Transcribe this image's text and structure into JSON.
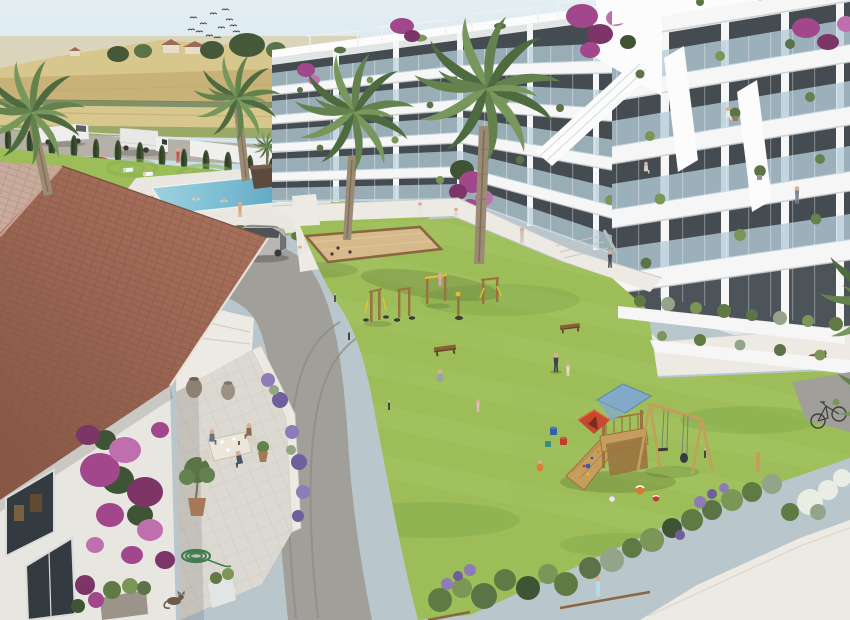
{
  "scene": {
    "type": "architectural-render",
    "title": "Aerial render of a Mediterranean apartment complex with communal garden, pool, playground and clubhouse",
    "setting": "sunny day, farmland horizon, flock of birds",
    "objects": [
      {
        "name": "sky",
        "label": "pale blue hazy sky"
      },
      {
        "name": "birds-flock",
        "label": "flock of birds",
        "count": 12
      },
      {
        "name": "farmland",
        "label": "golden crop fields with country houses and trees"
      },
      {
        "name": "perimeter-road",
        "label": "road with white van, box truck and parked red car"
      },
      {
        "name": "cypress-hedge",
        "label": "row of columnar cypress trees",
        "count": 15
      },
      {
        "name": "center-apartment-building",
        "label": "white apartment block, 5 balcony floors, rooftop pergolas"
      },
      {
        "name": "right-apartment-building",
        "label": "closer white apartment block with glass balconies and residents"
      },
      {
        "name": "bougainvillea",
        "label": "purple bougainvillea cascades"
      },
      {
        "name": "palm-trees",
        "label": "tall palm trees",
        "count": 5
      },
      {
        "name": "swimming-pool",
        "label": "communal pool with swimmers and loungers"
      },
      {
        "name": "lawn-art-circles",
        "label": "circular mown patterns on lawn"
      },
      {
        "name": "internal-road",
        "label": "curved asphalt drive with silver SUV and tyre tracks"
      },
      {
        "name": "central-lawn",
        "label": "large communal lawn"
      },
      {
        "name": "petanque-court",
        "label": "sand boules court with wooden border"
      },
      {
        "name": "outdoor-gym",
        "label": "wooden calisthenics equipment with yellow grips"
      },
      {
        "name": "playground",
        "label": "wooden play tower with blue roof, climbing ramp, swing set, red tent, buckets, beach balls"
      },
      {
        "name": "benches",
        "label": "wooden benches",
        "count": 3
      },
      {
        "name": "clubhouse",
        "label": "white clubhouse with terracotta tiled roof"
      },
      {
        "name": "clubhouse-terrace",
        "label": "dining terrace with three people at a table, olive tree, urns, coiled garden hose and a cat"
      },
      {
        "name": "lavender",
        "label": "lavender borders"
      },
      {
        "name": "shrub-border",
        "label": "mixed shrub border with white flowering bush"
      },
      {
        "name": "walkways",
        "label": "white concrete walkways"
      },
      {
        "name": "bicycle",
        "label": "bicycle leaning by planter"
      },
      {
        "name": "residents",
        "label": "people walking, children playing"
      }
    ],
    "counts": {
      "balcony_floors_center": 5,
      "balcony_floors_right": 5,
      "terrace_diners": 3,
      "swimmers": 2
    }
  },
  "palette": {
    "skyTop": "#e4eff3",
    "skyBot": "#c6dbe5",
    "fieldFar": "#d9d3b4",
    "fieldGold": "#c9b277",
    "fieldGold2": "#d8c78d",
    "fieldGreen": "#9aa868",
    "hedgerow": "#6b7c4a",
    "treeDark": "#45593a",
    "treeMid": "#5b7347",
    "houseWall": "#e6ddcb",
    "houseRoof": "#9c6b55",
    "roadTop": "#b5b1a8",
    "roadMain": "#a19f9a",
    "roadDark": "#8d8b86",
    "cypress": "#3c5231",
    "cypressDark": "#2f4227",
    "grass": "#9cbd58",
    "grassLight": "#aac868",
    "grassDark": "#7fa34a",
    "circleStroke": "#8db151",
    "deck": "#e9e7e0",
    "walk": "#eceae3",
    "walkShade": "#d0cdc4",
    "water": "#74b8cf",
    "waterLight": "#9ed2e0",
    "waterDeep": "#4e9ab6",
    "wallWhite": "#f5f6f5",
    "wallLight": "#fbfcfb",
    "wallShade": "#e2e5e5",
    "slabShadow": "#c7ccce",
    "glass": "#b5cdda",
    "winDark": "#333b41",
    "winFrame": "#d9dcdb",
    "roofA": "#a8715c",
    "roofB": "#8a5847",
    "roofLight": "#c8ab9c",
    "roofLine": "#7c4f42",
    "terr": "#dcd9d2",
    "parapet": "#ece9e2",
    "bougain": "#a3478c",
    "bougainDark": "#7d3568",
    "bougainLight": "#c06fae",
    "leafDark": "#3f5434",
    "lavender": "#8e7cb8",
    "lavenderDark": "#6f5f9c",
    "shrub": "#5f7b43",
    "shrubLight": "#7b9656",
    "shrubGray": "#94a489",
    "flowerWhite": "#e9ede4",
    "sand": "#d7ba8b",
    "sandEdge": "#8a6742",
    "woodPlay": "#c59e5d",
    "woodDark": "#9a7440",
    "playBlue": "#82aac8",
    "playBlueDark": "#5f8cae",
    "tentRed": "#c6492f",
    "ballRed": "#c23a28",
    "ballBlue": "#2f5fae",
    "ballOrange": "#d97a2a",
    "benchWood": "#8a5f38",
    "benchDark": "#664326",
    "vanWhite": "#eeeeec",
    "truckWhite": "#e8e8e6",
    "carRed": "#b23226",
    "suvGray": "#b7b6b2",
    "tire": "#3a3a38",
    "skin": "#dfae92",
    "trunk": "#9c8b74",
    "trunkDark": "#7e6e58",
    "palmDark": "#4e6b40",
    "palmMid": "#63824e",
    "palmLight": "#78975c",
    "hose": "#3f7d4e",
    "cat": "#6b5b4a",
    "potClay": "#a77857",
    "potGray": "#9a948a",
    "urn": "#8d8172",
    "postDark": "#4a453e",
    "postLight": "#cfc9b8",
    "yellowAccent": "#e4c238",
    "birdDark": "#3b403b"
  }
}
